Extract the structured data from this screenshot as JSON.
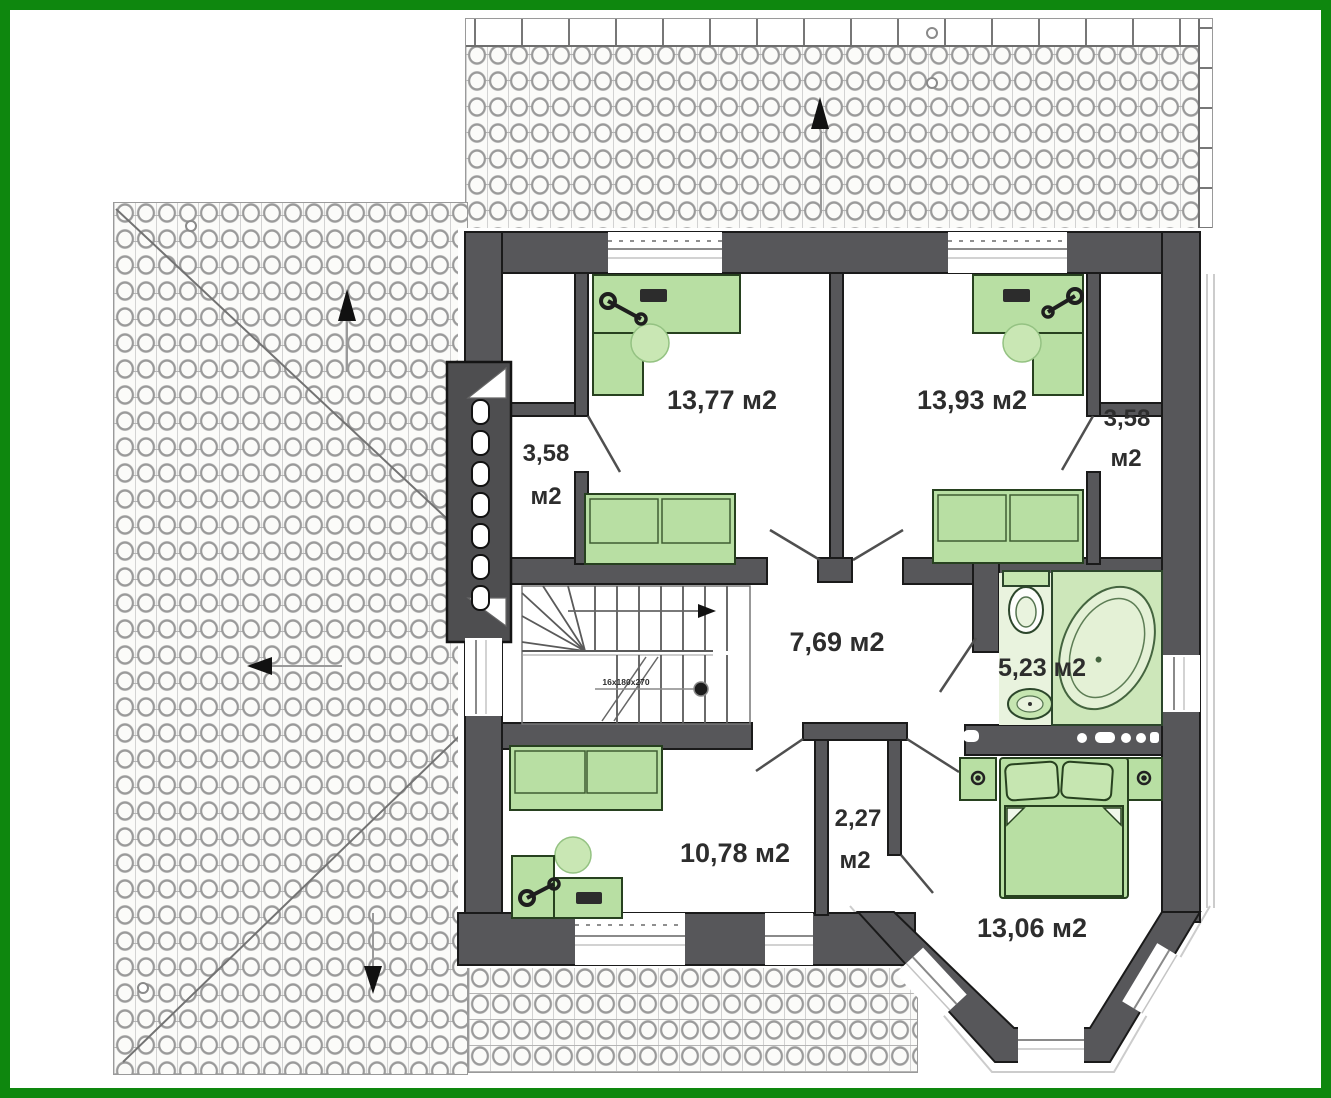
{
  "title": "second-floor-plan",
  "colors": {
    "frame_green": "#0e870e",
    "wall_gray": "#57575a",
    "furniture_green": "#b8dfa3",
    "furniture_light_green": "#c6e6b1",
    "bathroom_floor": "#e9f3de",
    "outline_black": "#1a1a1a"
  },
  "rooms": {
    "room_top_left": {
      "area": "13,77 м2"
    },
    "room_top_right": {
      "area": "13,93 м2"
    },
    "closet_left": {
      "area_value": "3,58",
      "area_unit": "м2"
    },
    "closet_right": {
      "area_value": "3,58",
      "area_unit": "м2"
    },
    "hall": {
      "area": "7,69 м2"
    },
    "bathroom": {
      "area": "5,23 м2"
    },
    "room_bottom_left": {
      "area": "10,78 м2"
    },
    "closet_center": {
      "area_value": "2,27",
      "area_unit": "м2"
    },
    "bedroom": {
      "area": "13,06 м2"
    }
  },
  "stairs": {
    "annotation": "16x180x270"
  },
  "icons": {
    "roof_arrows": [
      "arrow-up",
      "arrow-up",
      "arrow-left",
      "arrow-down"
    ]
  }
}
